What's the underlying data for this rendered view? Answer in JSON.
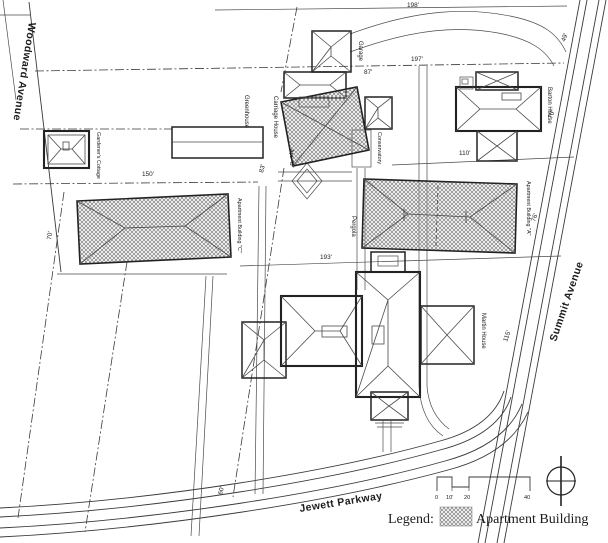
{
  "streets": {
    "woodward": "Woodward Avenue",
    "summit": "Summit Avenue",
    "jewett": "Jewett Parkway"
  },
  "buildings": {
    "cottage": "Gardener's Cottage",
    "greenhouse": "Greenhouse",
    "carriage": "Carriage House",
    "garage": "Garage",
    "conservatory": "Conservatory",
    "pergola": "Pergola",
    "barton": "Barton House",
    "martin": "Martin House",
    "apt_a": "Apartment Building \"A\"",
    "apt_b": "Apt. \"B\"",
    "apt_c": "Apartment Building \"C\""
  },
  "dims": {
    "d198": "198'",
    "d197": "197'",
    "d87": "87'",
    "d49": "49'",
    "d110": "110'",
    "d150": "150'",
    "d70w": "70'",
    "d70e": "70'",
    "d76": "76'",
    "d115": "115'",
    "d193": "193'",
    "d83": "83'",
    "d60": "60'"
  },
  "scale_bar": {
    "t0": "0",
    "t10": "10'",
    "t20": "20",
    "t40": "40"
  },
  "legend": {
    "label": "Legend:",
    "entry": "Apartment Building"
  }
}
